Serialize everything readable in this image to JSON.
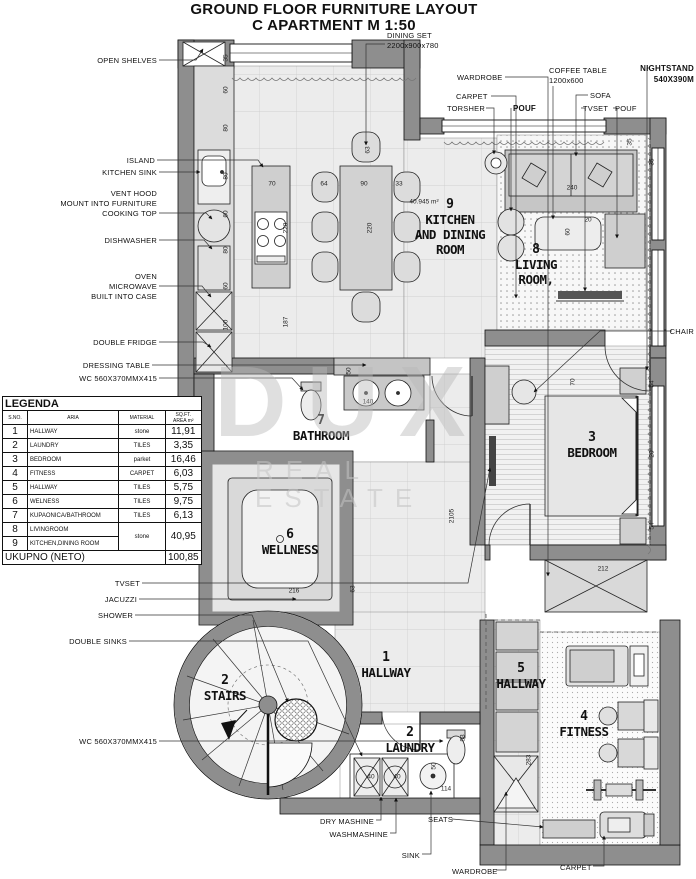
{
  "title": {
    "line1": "GROUND FLOOR FURNITURE LAYOUT",
    "line2": "C APARTMENT M 1:50"
  },
  "watermark": {
    "line1": "DUX",
    "line2": "REAL ESTATE"
  },
  "colors": {
    "wall_gray": "#8e8e8e",
    "line_black": "#111111",
    "floor_light": "#ececec"
  },
  "room_labels": [
    {
      "n": "9",
      "t": "KITCHEN\nAND DINING\nROOM",
      "x": 450,
      "y": 198
    },
    {
      "n": "8",
      "t": "LIVING\nROOM,",
      "x": 536,
      "y": 243
    },
    {
      "n": "7",
      "t": "BATHROOM",
      "x": 321,
      "y": 414
    },
    {
      "n": "3",
      "t": "BEDROOM",
      "x": 592,
      "y": 431
    },
    {
      "n": "6",
      "t": "WELLNESS",
      "x": 290,
      "y": 528
    },
    {
      "n": "1",
      "t": "HALLWAY",
      "x": 386,
      "y": 651
    },
    {
      "n": "2",
      "t": "STAIRS",
      "x": 225,
      "y": 674
    },
    {
      "n": "2",
      "t": "LAUNDRY",
      "x": 410,
      "y": 726
    },
    {
      "n": "5",
      "t": "HALLWAY",
      "x": 521,
      "y": 662
    },
    {
      "n": "4",
      "t": "FITNESS",
      "x": 584,
      "y": 710
    }
  ],
  "callouts": [
    {
      "t": "OPEN SHELVES",
      "x": 157,
      "y": 56,
      "a": "r",
      "lead": [
        [
          159,
          60
        ],
        [
          196,
          60
        ],
        [
          203,
          49
        ]
      ]
    },
    {
      "t": "ISLAND",
      "x": 155,
      "y": 156,
      "a": "r",
      "lead": [
        [
          157,
          160
        ],
        [
          258,
          160
        ],
        [
          263,
          167
        ]
      ]
    },
    {
      "t": "KITCHEN SINK",
      "x": 157,
      "y": 168,
      "a": "r",
      "lead": [
        [
          159,
          172
        ],
        [
          200,
          172
        ]
      ]
    },
    {
      "t": "VENT HOOD\nMOUNT INTO FURNITURE\nCOOKING TOP",
      "x": 157,
      "y": 189,
      "a": "r",
      "lead": [
        [
          159,
          213
        ],
        [
          206,
          213
        ],
        [
          212,
          219
        ]
      ]
    },
    {
      "t": "DISHWASHER",
      "x": 157,
      "y": 236,
      "a": "r",
      "lead": [
        [
          159,
          240
        ],
        [
          204,
          240
        ],
        [
          212,
          249
        ]
      ]
    },
    {
      "t": "OVEN\nMICROWAVE\nBUILT INTO CASE",
      "x": 157,
      "y": 272,
      "a": "r",
      "lead": [
        [
          159,
          286
        ],
        [
          202,
          286
        ],
        [
          211,
          297
        ]
      ]
    },
    {
      "t": "DOUBLE FRIDGE",
      "x": 157,
      "y": 338,
      "a": "r",
      "lead": [
        [
          159,
          342
        ],
        [
          203,
          342
        ],
        [
          211,
          347
        ]
      ]
    },
    {
      "t": "DRESSING TABLE",
      "x": 150,
      "y": 361,
      "a": "r",
      "lead": [
        [
          152,
          365
        ],
        [
          366,
          365
        ]
      ]
    },
    {
      "t": "WC  560X370MMX415",
      "x": 157,
      "y": 374,
      "a": "r",
      "lead": [
        [
          159,
          378
        ],
        [
          292,
          378
        ],
        [
          303,
          390
        ]
      ]
    },
    {
      "t": "TVSET",
      "x": 140,
      "y": 579,
      "a": "r",
      "lead": [
        [
          142,
          583
        ],
        [
          468,
          583
        ],
        [
          490,
          468
        ]
      ]
    },
    {
      "t": "JACUZZI",
      "x": 137,
      "y": 595,
      "a": "r",
      "lead": [
        [
          139,
          599
        ],
        [
          296,
          599
        ]
      ]
    },
    {
      "t": "SHOWER",
      "x": 133,
      "y": 611,
      "a": "r",
      "lead": [
        [
          135,
          615
        ],
        [
          252,
          615
        ],
        [
          288,
          702
        ]
      ]
    },
    {
      "t": "DOUBLE SINKS",
      "x": 127,
      "y": 637,
      "a": "r",
      "lead": [
        [
          129,
          641
        ],
        [
          308,
          641
        ],
        [
          362,
          756
        ]
      ]
    },
    {
      "t": "WC  560X370MMX415",
      "x": 157,
      "y": 737,
      "a": "r",
      "lead": [
        [
          159,
          741
        ],
        [
          443,
          741
        ]
      ]
    },
    {
      "t": "DINING SET\n2200x900x780",
      "x": 387,
      "y": 31,
      "a": "l",
      "lead": [
        [
          385,
          44
        ],
        [
          366,
          44
        ],
        [
          366,
          145
        ]
      ]
    },
    {
      "t": "WARDROBE",
      "x": 457,
      "y": 73,
      "a": "l",
      "lead": [
        [
          505,
          77
        ],
        [
          548,
          77
        ],
        [
          548,
          576
        ]
      ]
    },
    {
      "t": "CARPET",
      "x": 456,
      "y": 92,
      "a": "l",
      "lead": [
        [
          491,
          96
        ],
        [
          516,
          96
        ],
        [
          516,
          298
        ]
      ]
    },
    {
      "t": "TORSHER",
      "x": 447,
      "y": 104,
      "a": "l",
      "lead": [
        [
          486,
          108
        ],
        [
          494,
          108
        ],
        [
          494,
          154
        ]
      ]
    },
    {
      "t": "POUF",
      "x": 513,
      "y": 104,
      "a": "l",
      "b": 1,
      "lead": [
        [
          511,
          108
        ],
        [
          511,
          211
        ]
      ]
    },
    {
      "t": "COFFEE TABLE\n1200x600",
      "x": 549,
      "y": 66,
      "a": "l",
      "lead": [
        [
          553,
          86
        ],
        [
          553,
          219
        ]
      ]
    },
    {
      "t": "SOFA",
      "x": 590,
      "y": 91,
      "a": "l",
      "lead": [
        [
          588,
          95
        ],
        [
          576,
          95
        ],
        [
          576,
          156
        ]
      ]
    },
    {
      "t": "TVSET",
      "x": 583,
      "y": 104,
      "a": "l",
      "lead": [
        [
          581,
          108
        ],
        [
          585,
          108
        ],
        [
          585,
          291
        ]
      ]
    },
    {
      "t": "POUF",
      "x": 615,
      "y": 104,
      "a": "l",
      "lead": [
        [
          613,
          108
        ],
        [
          617,
          108
        ],
        [
          617,
          238
        ]
      ]
    },
    {
      "t": "NIGHTSTAND\n540X390M",
      "x": 694,
      "y": 64,
      "a": "r",
      "b": 1,
      "lead": [
        [
          650,
          68
        ],
        [
          647,
          68
        ],
        [
          647,
          370
        ]
      ]
    },
    {
      "t": "CHAIR",
      "x": 694,
      "y": 327,
      "a": "r",
      "lead": [
        [
          672,
          331
        ],
        [
          600,
          331
        ],
        [
          534,
          392
        ]
      ]
    },
    {
      "t": "DRY MASHINE",
      "x": 374,
      "y": 817,
      "a": "r",
      "lead": [
        [
          376,
          820
        ],
        [
          381,
          820
        ],
        [
          381,
          797
        ]
      ]
    },
    {
      "t": "WASHMASHINE",
      "x": 388,
      "y": 830,
      "a": "r",
      "lead": [
        [
          390,
          833
        ],
        [
          396,
          833
        ],
        [
          396,
          798
        ]
      ]
    },
    {
      "t": "SINK",
      "x": 420,
      "y": 851,
      "a": "r",
      "lead": [
        [
          422,
          854
        ],
        [
          431,
          854
        ],
        [
          431,
          791
        ]
      ]
    },
    {
      "t": "SEATS",
      "x": 428,
      "y": 815,
      "a": "l",
      "lead": [
        [
          452,
          819
        ],
        [
          543,
          827
        ]
      ]
    },
    {
      "t": "WARDROBE",
      "x": 452,
      "y": 867,
      "a": "l",
      "lead": [
        [
          496,
          870
        ],
        [
          506,
          870
        ],
        [
          506,
          792
        ]
      ]
    },
    {
      "t": "CARPET",
      "x": 560,
      "y": 863,
      "a": "l",
      "lead": [
        [
          593,
          866
        ],
        [
          604,
          866
        ],
        [
          604,
          836
        ]
      ]
    }
  ],
  "dims": [
    [
      "35",
      226,
      58,
      1
    ],
    [
      "60",
      226,
      90,
      1
    ],
    [
      "80",
      226,
      128,
      1
    ],
    [
      "80",
      226,
      176,
      1
    ],
    [
      "60",
      226,
      214,
      1
    ],
    [
      "80",
      226,
      250,
      1
    ],
    [
      "60",
      226,
      286,
      1
    ],
    [
      "100",
      226,
      325,
      1
    ],
    [
      "70",
      272,
      184,
      0
    ],
    [
      "220",
      286,
      228,
      1
    ],
    [
      "187",
      286,
      322,
      1
    ],
    [
      "64",
      324,
      184,
      0
    ],
    [
      "90",
      364,
      184,
      0
    ],
    [
      "33",
      399,
      184,
      0
    ],
    [
      "63",
      368,
      150,
      1
    ],
    [
      "220",
      370,
      228,
      1
    ],
    [
      "240",
      572,
      188,
      0
    ],
    [
      "35",
      630,
      142,
      1
    ],
    [
      "35",
      652,
      162,
      1
    ],
    [
      "20",
      588,
      220,
      0
    ],
    [
      "60",
      568,
      232,
      1
    ],
    [
      "50",
      349,
      371,
      1
    ],
    [
      "140",
      368,
      402,
      0
    ],
    [
      "2105",
      452,
      516,
      1
    ],
    [
      "216",
      294,
      591,
      0
    ],
    [
      "63",
      353,
      589,
      1
    ],
    [
      "70",
      573,
      382,
      1
    ],
    [
      "54",
      652,
      384,
      1
    ],
    [
      "54",
      652,
      526,
      1
    ],
    [
      "20",
      652,
      454,
      1
    ],
    [
      "212",
      603,
      569,
      0
    ],
    [
      "283",
      529,
      760,
      1
    ],
    [
      "114",
      446,
      789,
      0
    ],
    [
      "50",
      434,
      766,
      1
    ],
    [
      "83",
      463,
      738,
      1
    ],
    [
      "40",
      371,
      777,
      0
    ],
    [
      "40",
      397,
      777,
      0
    ],
    [
      "40.945 m²",
      424,
      202,
      0
    ]
  ],
  "legend": {
    "title": "LEGENDA",
    "headers": [
      "S.NO.",
      "ARIA",
      "MATERIAL",
      "SQ.FT.\nAREA m²"
    ],
    "rows": [
      [
        "1",
        "HALLWAY",
        "stone",
        "11,91",
        1
      ],
      [
        "2",
        "LAUNDRY",
        "TILES",
        "3,35",
        1
      ],
      [
        "3",
        "BEDROOM",
        "parket",
        "16,46",
        1
      ],
      [
        "4",
        "FITNESS",
        "CARPET",
        "6,03",
        1
      ],
      [
        "5",
        "HALLWAY",
        "TILES",
        "5,75",
        1
      ],
      [
        "6",
        "WELNESS",
        "TILES",
        "9,75",
        1
      ],
      [
        "7",
        "KUPAONICA/BATHROOM",
        "TILES",
        "6,13",
        1
      ],
      [
        "8",
        "LIVINGROOM",
        "stone",
        "40,95",
        2
      ],
      [
        "9",
        "KITCHEN,DINING ROOM",
        null,
        null,
        0
      ]
    ],
    "total_label": "UKUPNO (NETO)",
    "total_value": "100,85"
  }
}
